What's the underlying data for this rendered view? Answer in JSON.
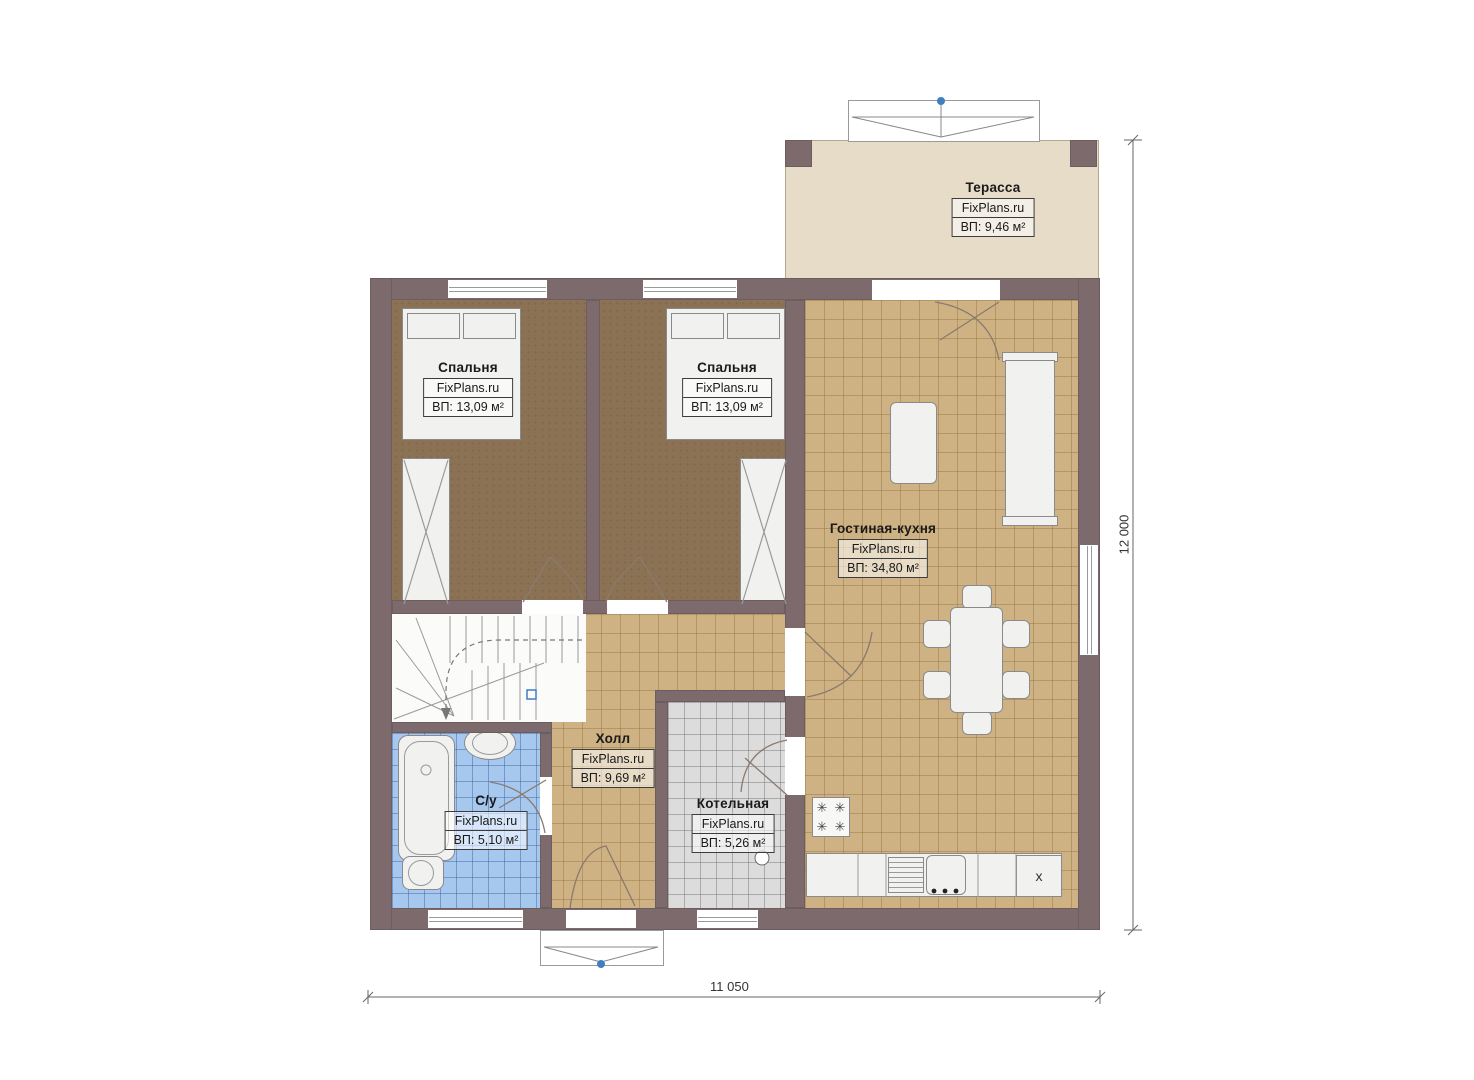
{
  "watermark": "FixPlans.ru",
  "rooms": {
    "terrace": {
      "name": "Терасса",
      "brand": "FixPlans.ru",
      "area": "ВП: 9,46 м²"
    },
    "bedroom1": {
      "name": "Спальня",
      "brand": "FixPlans.ru",
      "area": "ВП: 13,09 м²"
    },
    "bedroom2": {
      "name": "Спальня",
      "brand": "FixPlans.ru",
      "area": "ВП: 13,09 м²"
    },
    "living": {
      "name": "Гостиная-кухня",
      "brand": "FixPlans.ru",
      "area": "ВП: 34,80 м²"
    },
    "hall": {
      "name": "Холл",
      "brand": "FixPlans.ru",
      "area": "ВП: 9,69 м²"
    },
    "bathroom": {
      "name": "С/у",
      "brand": "FixPlans.ru",
      "area": "ВП: 5,10 м²"
    },
    "boiler": {
      "name": "Котельная",
      "brand": "FixPlans.ru",
      "area": "ВП: 5,26 м²"
    }
  },
  "dimensions": {
    "overall_width": "11 050",
    "overall_height": "12 000"
  },
  "symbols": {
    "fridge_mark": "x",
    "burner": "✳"
  },
  "colors": {
    "wall": "#7d6a6d",
    "carpet": "#8b7254",
    "tile_tan": "#cfb284",
    "tile_blue": "#a6c8ef",
    "tile_gray": "#dcdcdc",
    "terrace": "#e7dcc8",
    "marker_blue": "#3f7fc1"
  }
}
